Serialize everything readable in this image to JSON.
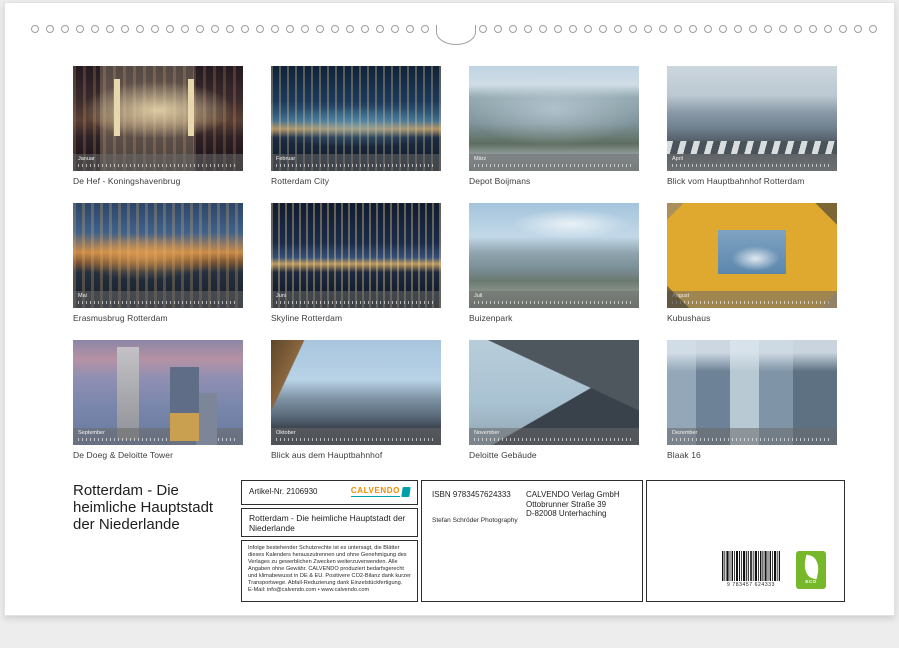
{
  "binding": {
    "left_holes": 27,
    "right_holes": 27
  },
  "grid": {
    "months": [
      {
        "label": "Januar",
        "caption": "De Hef - Koningshavenbrug"
      },
      {
        "label": "Februar",
        "caption": "Rotterdam City"
      },
      {
        "label": "März",
        "caption": "Depot Boijmans"
      },
      {
        "label": "April",
        "caption": "Blick vom Hauptbahnhof Rotterdam"
      },
      {
        "label": "Mai",
        "caption": "Erasmusbrug Rotterdam"
      },
      {
        "label": "Juni",
        "caption": "Skyline Rotterdam"
      },
      {
        "label": "Juli",
        "caption": "Buizenpark"
      },
      {
        "label": "August",
        "caption": "Kubushaus"
      },
      {
        "label": "September",
        "caption": "De Doeg & Deloitte Tower"
      },
      {
        "label": "Oktober",
        "caption": "Blick aus dem Hauptbahnhof"
      },
      {
        "label": "November",
        "caption": "Deloitte Gebäude"
      },
      {
        "label": "Dezember",
        "caption": "Blaak 16"
      }
    ]
  },
  "footer": {
    "title": "Rotterdam - Die\nheimliche Hauptstadt\nder Niederlande",
    "article_label": "Artikel-Nr. 2106930",
    "brand_name": "CALVENDO",
    "box_title": "Rotterdam - Die heimliche Hauptstadt der Niederlande",
    "legal": "Infolge bestehender Schutzrechte ist es untersagt, die Blätter dieses Kalenders herauszutrennen und ohne Genehmigung des Verlages zu gewerblichen Zwecken weiterzuverwenden. Alle Angaben ohne Gewähr. CALVENDO produziert bedarfsgerecht und klimabewusst in DE & EU. Positivere CO2-Bilanz dank kurzer Transportwege. Abfall-Reduzierung dank Einzelstückfertigung.\nE-Mail: info@calvendo.com • www.calvendo.com",
    "isbn": "ISBN 9783457624333",
    "publisher": "CALVENDO Verlag GmbH\nOttobrunner Straße 39\nD-82008 Unterhaching",
    "photographer": "Stefan Schröder Photography",
    "barcode_digits": "9 783457 624333",
    "eco_label": "ECO"
  },
  "colors": {
    "brand_orange": "#ee8b00",
    "brand_teal": "#00a0a8",
    "eco_green": "#76b82a"
  }
}
